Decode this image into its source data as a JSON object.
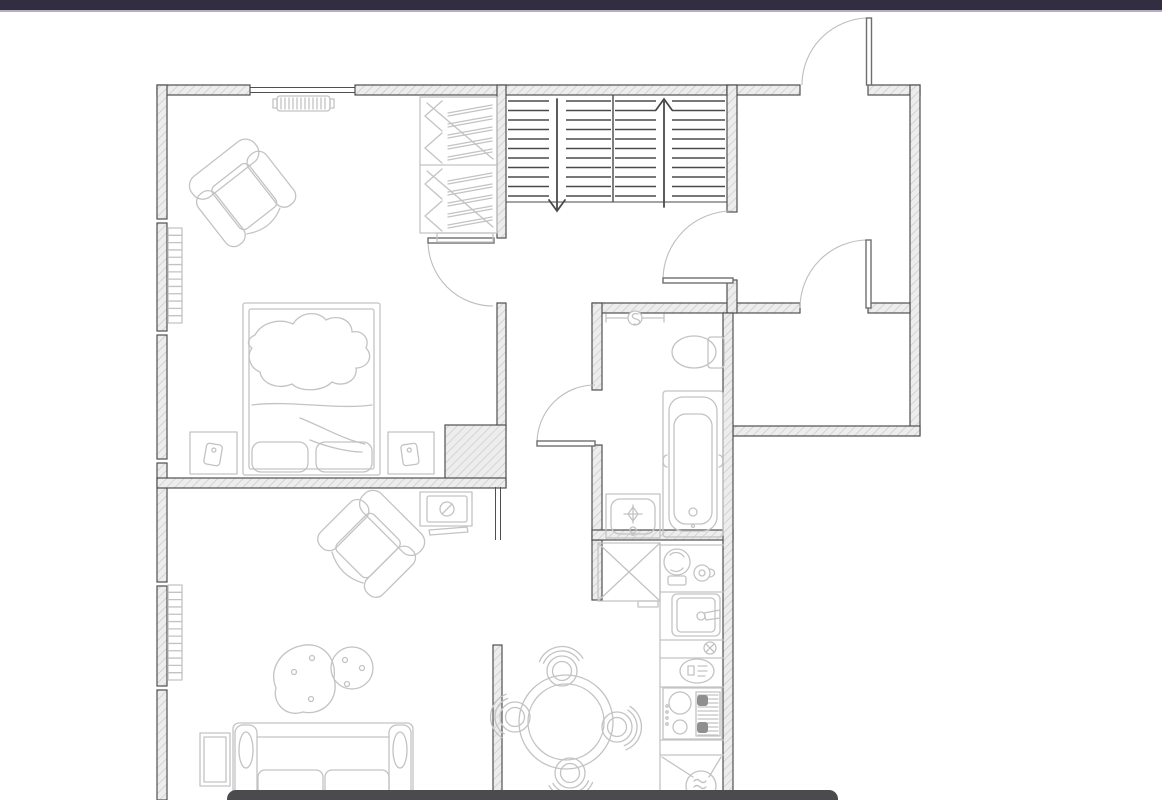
{
  "window": {
    "title": "apartment floor plan"
  },
  "colors": {
    "page_bg": "#ffffff",
    "top_bar": "#332d42",
    "top_bar_border": "#b5aec1",
    "panel": "#4b4b4d",
    "wall_stroke": "#4f4f4f",
    "wall_fill": "#ededed",
    "hatch_line": "#c6c6c6",
    "furniture": "#c3c3c3",
    "door_leaf": "#6e6e6e",
    "door_arc": "#bdbdbd",
    "stair": "#4a4a4a",
    "appliance_dark": "#8f8f8f"
  },
  "plan": {
    "rooms": [
      {
        "name": "Bedroom",
        "furniture": [
          "armchair",
          "double bed with blanket",
          "nightstand x2",
          "wardrobe with clothes rails",
          "radiator",
          "wall vent"
        ]
      },
      {
        "name": "Living room",
        "furniture": [
          "sofa",
          "coffee table x2",
          "armchair",
          "TV on stand",
          "side table",
          "radiator"
        ]
      },
      {
        "name": "Staircase hall",
        "furniture": [
          "stair flight down",
          "stair flight up"
        ]
      },
      {
        "name": "Entry hall",
        "furniture": [
          "entry door"
        ]
      },
      {
        "name": "Storage room",
        "furniture": []
      },
      {
        "name": "Bathroom",
        "furniture": [
          "towel rail",
          "toilet",
          "bathtub",
          "washbasin"
        ]
      },
      {
        "name": "Kitchen / dining",
        "furniture": [
          "corner cabinet",
          "coffee machine",
          "cup",
          "kitchen sink",
          "shut-off valve",
          "cutlery tray",
          "stove with oven",
          "washing machine",
          "round dining table",
          "dining chair x4"
        ]
      }
    ],
    "doors": [
      {
        "name": "entry-door",
        "swing": "outward-up"
      },
      {
        "name": "hall-to-entry-door",
        "swing": "into-hall"
      },
      {
        "name": "storage-room-door",
        "swing": "into-entry-hall"
      },
      {
        "name": "bedroom-door",
        "swing": "into-bedroom"
      },
      {
        "name": "bathroom-door",
        "swing": "into-corridor"
      }
    ],
    "stairs": {
      "y_top": 101,
      "y_bottom": 196,
      "step": 9.5,
      "halves": [
        [
          508,
          549
        ],
        [
          566,
          611
        ],
        [
          615,
          656
        ],
        [
          672,
          725
        ]
      ],
      "arrows": [
        "down",
        "up"
      ]
    },
    "radiators": [
      {
        "x": 168,
        "y": 228,
        "w": 14,
        "h": 95,
        "rungs": 13
      },
      {
        "x": 168,
        "y": 585,
        "w": 14,
        "h": 95,
        "rungs": 13
      }
    ],
    "vent": {
      "x": 277,
      "y": 96,
      "w": 53,
      "h": 15
    },
    "wardrobe": {
      "sections": [
        {
          "y": 99
        },
        {
          "y": 167
        }
      ],
      "lines_per_section": 5
    },
    "dining": {
      "cx": 566,
      "cy": 722,
      "r_outer": 47,
      "r_inner": 38,
      "chairs": [
        {
          "cx": 562,
          "cy": 671
        },
        {
          "cx": 617,
          "cy": 727
        },
        {
          "cx": 570,
          "cy": 773
        },
        {
          "cx": 515,
          "cy": 717
        }
      ]
    },
    "stove": {
      "grill": {
        "x1": 698,
        "x2": 718,
        "y1": 695,
        "y2": 735,
        "step": 4
      }
    }
  }
}
